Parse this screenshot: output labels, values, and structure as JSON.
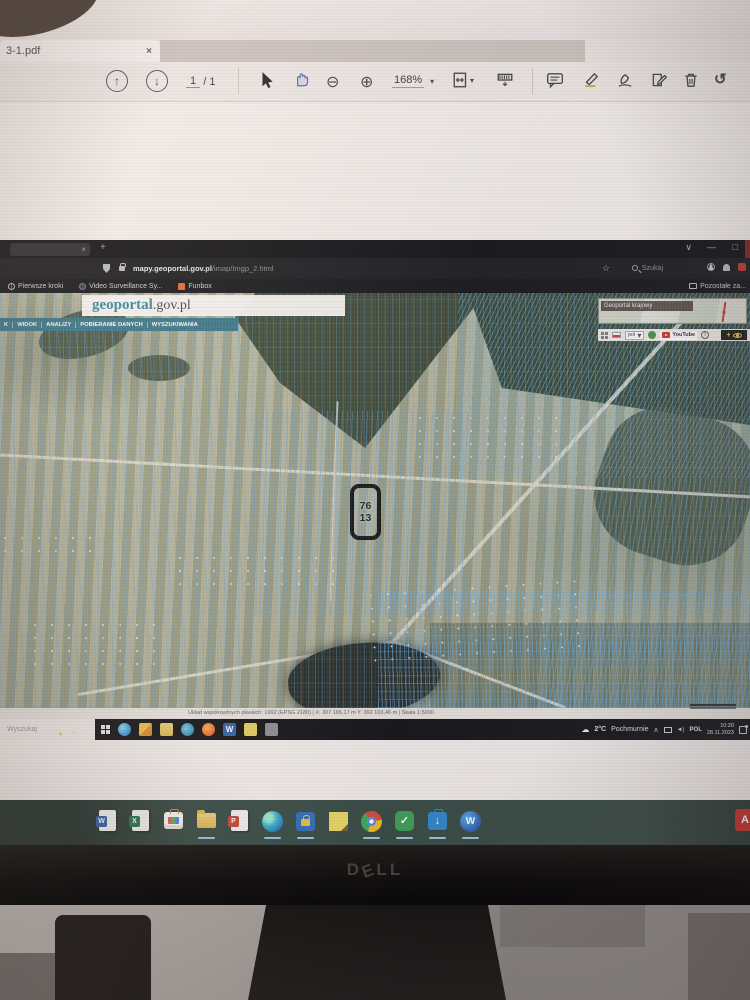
{
  "pdf_viewer": {
    "tab_title": "3-1.pdf",
    "tab_close": "×",
    "toolbar": {
      "page_current": "1",
      "page_sep": "/",
      "page_total": "1",
      "zoom_level": "168%"
    }
  },
  "browser": {
    "titlebar": {
      "tab_close": "×",
      "new_tab": "+",
      "menu_chevron": "∨",
      "minimize": "—",
      "restore": "□"
    },
    "address": {
      "domain": "mapy.geoportal.gov.pl",
      "path": "/imap/Imgp_2.html",
      "bookmark_star": "☆",
      "search_placeholder": "Szukaj"
    },
    "bookmarks": {
      "items": [
        {
          "label": "Pierwsze kroki"
        },
        {
          "label": "Video Surveillance Sy..."
        },
        {
          "label": "Funbox"
        }
      ],
      "other_label": "Pozostałe za..."
    }
  },
  "geoportal": {
    "logo_primary": "geoportal",
    "logo_suffix": ".gov.pl",
    "menu_items": [
      {
        "label": "K"
      },
      {
        "label": "WIDOK"
      },
      {
        "label": "ANALIZY"
      },
      {
        "label": "POBIERANIE DANYCH"
      },
      {
        "label": "WYSZUKIWANIA"
      }
    ],
    "minimap_title": "Geoportal krajowy",
    "widgets": {
      "language": "pol",
      "youtube": "YouTube"
    },
    "parcel": {
      "top": "76",
      "bottom": "13"
    },
    "status_text": "Układ współrzędnych płaskich: 1992 (EPSG 2180)   |   X: 307 165,17 m   Y: 392 103,46 m   |   Skala 1:5000"
  },
  "inner_taskbar": {
    "search_label": "Wyszukaj",
    "weather_temp": "2°C",
    "weather_condition": "Pochmurnie",
    "tray_chevron": "∧",
    "tray_language": "POL",
    "tray_time": "10:20",
    "tray_date": "28.11.2023"
  },
  "monitor": {
    "brand_letters": [
      {
        "ch": "D"
      },
      {
        "ch": "E"
      },
      {
        "ch": "L"
      },
      {
        "ch": "L"
      }
    ]
  }
}
